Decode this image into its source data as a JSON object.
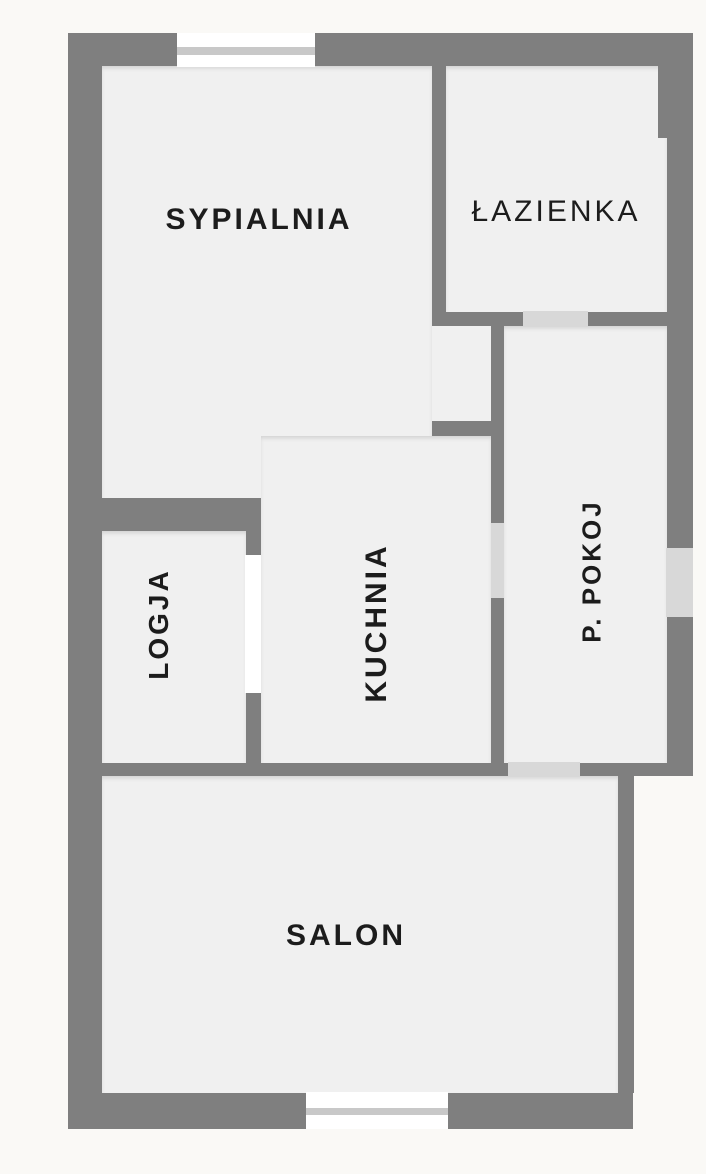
{
  "floorplan": {
    "type": "apartment-floor-plan",
    "rooms": [
      {
        "id": "sypialnia",
        "label": "SYPIALNIA",
        "label_rotation": "horizontal"
      },
      {
        "id": "lazienka",
        "label": "ŁAZIENKA",
        "label_rotation": "horizontal"
      },
      {
        "id": "p_pokoj",
        "label": "P. POKOJ",
        "label_rotation": "vertical"
      },
      {
        "id": "kuchnia",
        "label": "KUCHNIA",
        "label_rotation": "vertical"
      },
      {
        "id": "logja",
        "label": "LOGJA",
        "label_rotation": "vertical"
      },
      {
        "id": "salon",
        "label": "SALON",
        "label_rotation": "horizontal"
      }
    ],
    "colors": {
      "background": "#faf9f6",
      "wall": "#7f7f7f",
      "floor": "#f0f0f0",
      "door_opening": "#d8d8d8",
      "window_glass": "#ffffff",
      "window_frame": "#c8c8c8",
      "label_text": "#1c1c1c"
    }
  }
}
